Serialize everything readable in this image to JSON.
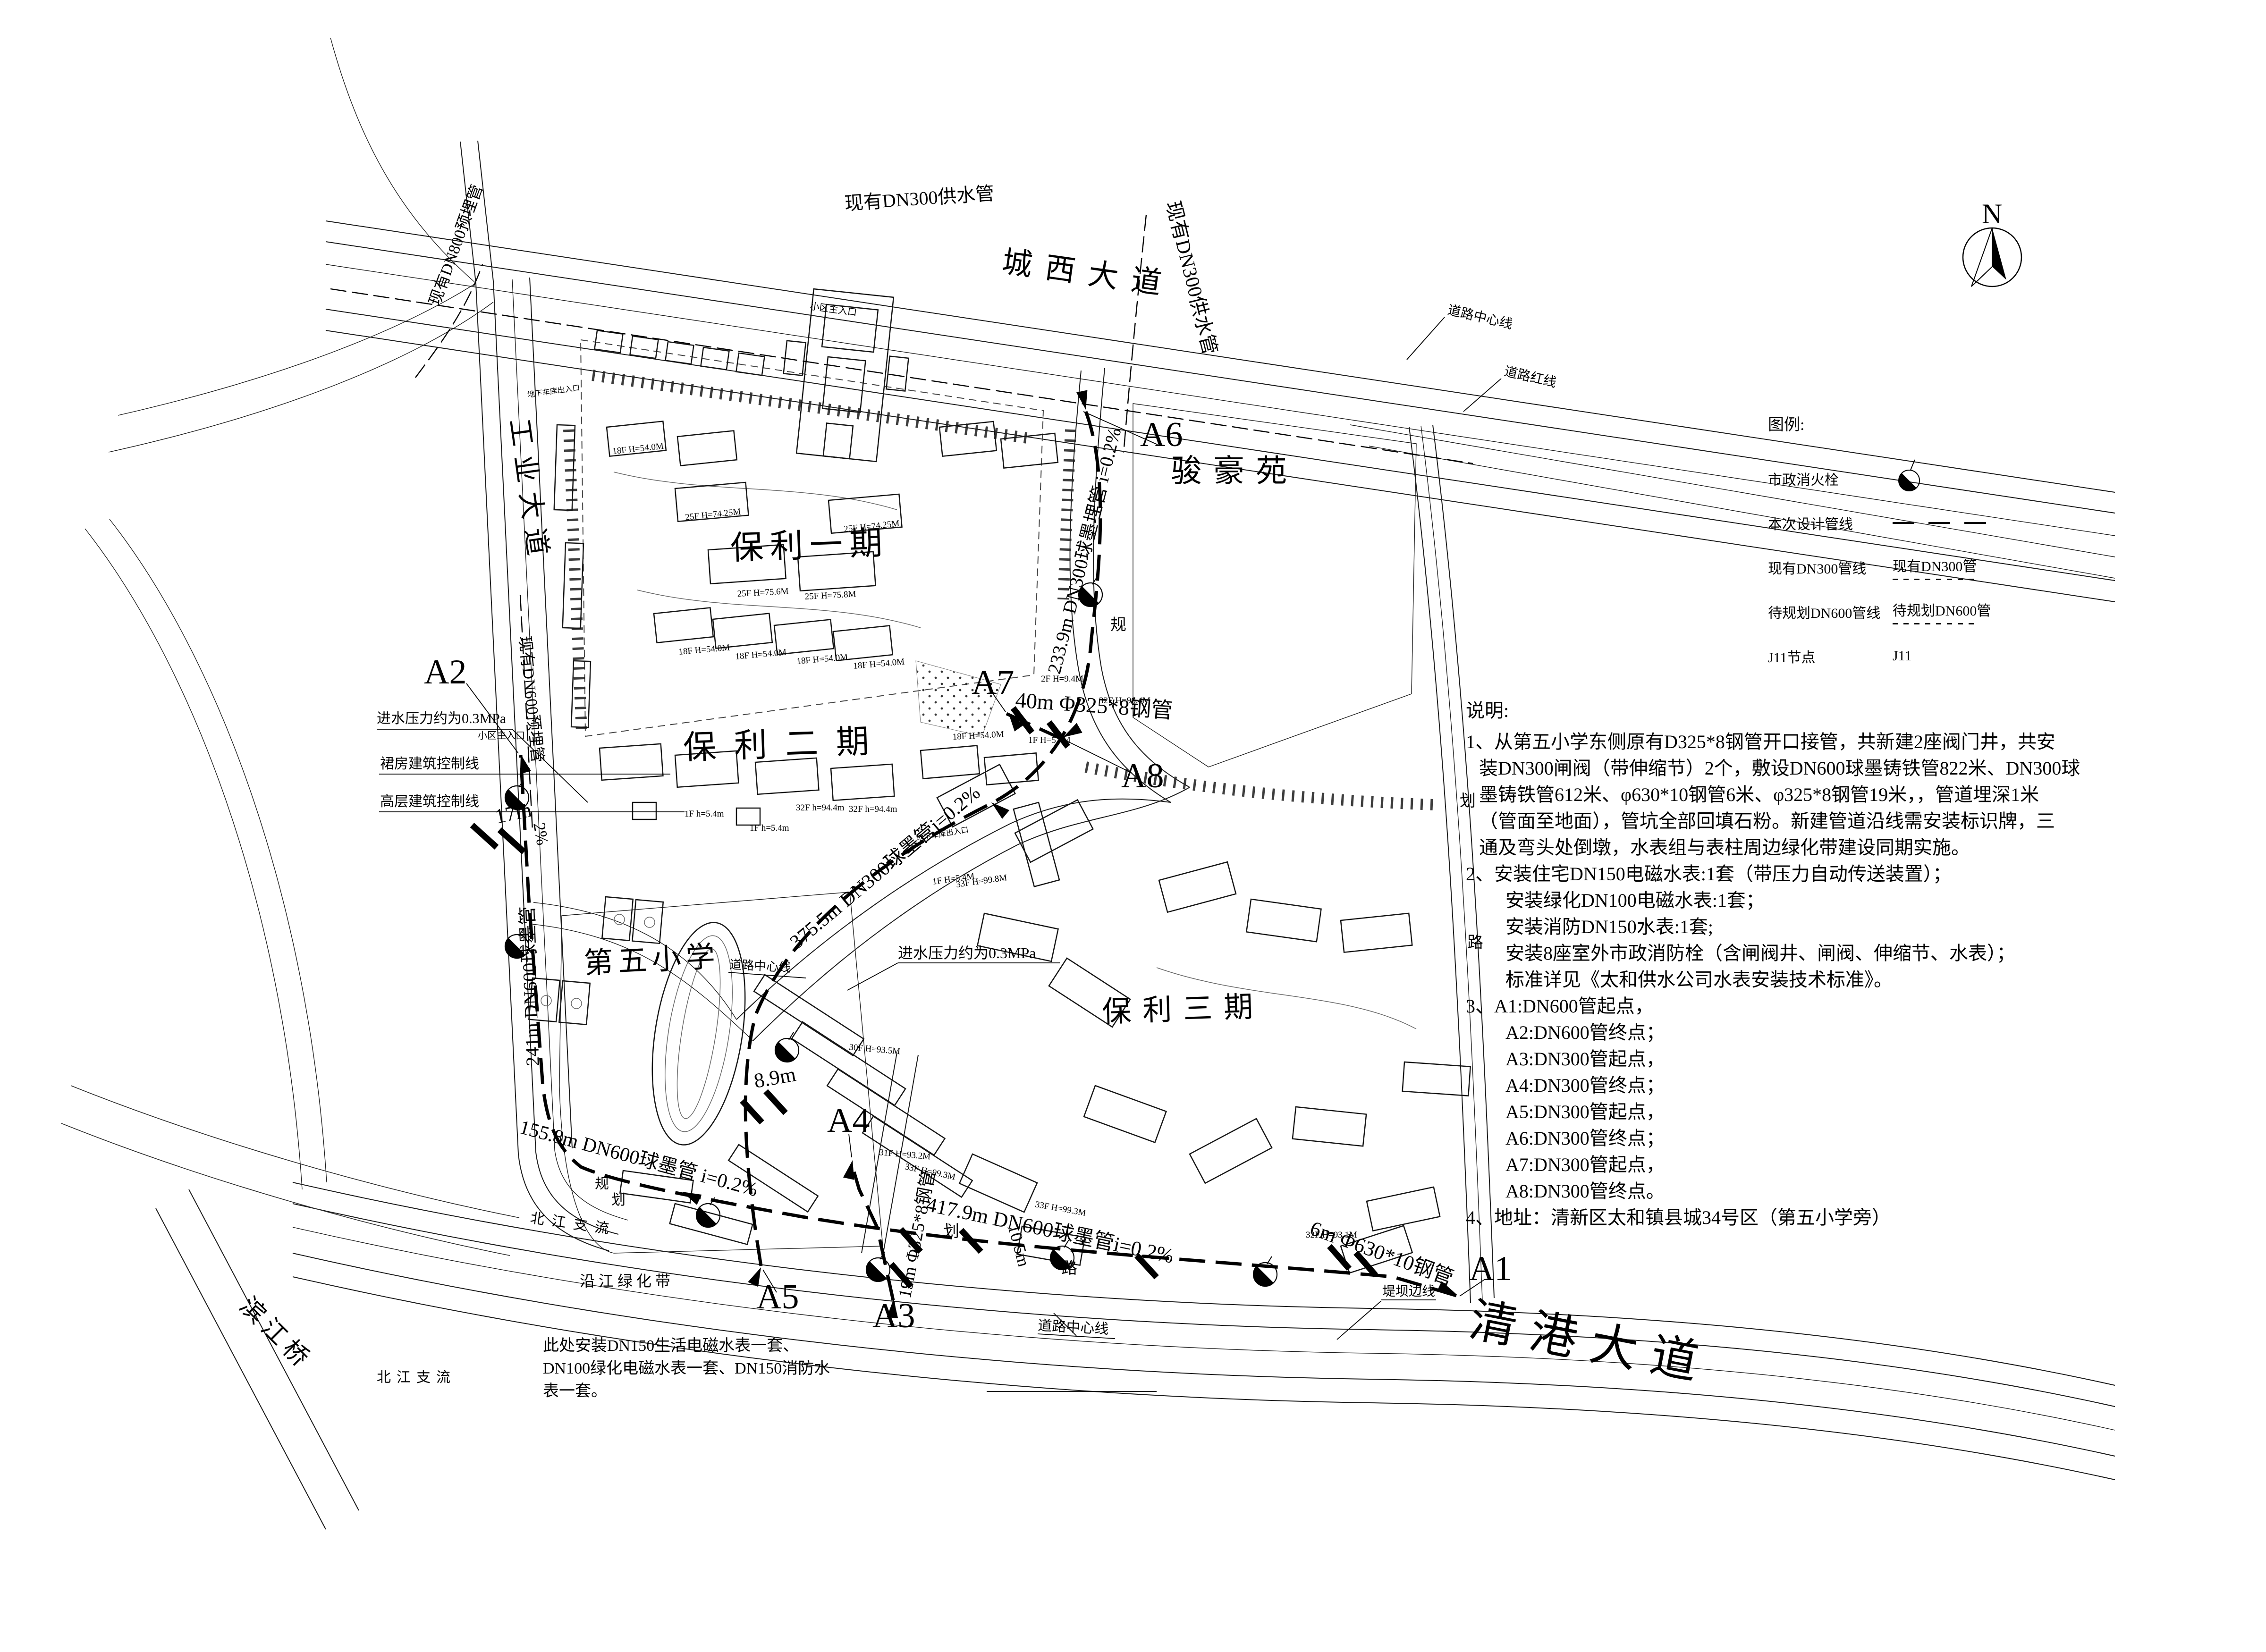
{
  "roads": {
    "chengxi": "城西大道",
    "gongye": "工业大道",
    "qinggang": "清港大道",
    "binjiangqiao": "滨江桥",
    "center_line_tr": "道路中心线",
    "red_line_tr": "道路红线",
    "center_line_school": "道路中心线",
    "center_line_bottom": "道路中心线",
    "dike_edge": "堤坝边线"
  },
  "areas": {
    "junhao": "骏豪苑",
    "baoli1": "保利一期",
    "baoli2": "保利二期",
    "baoli3": "保利三期",
    "school": "第五小学",
    "green_belt": "沿江绿化带",
    "river1": "北江支流",
    "river2": "北江支流"
  },
  "pipes": {
    "existing_dn300_top": "现有DN300供水管",
    "existing_dn300_side": "现有DN300供水管",
    "existing_dn800": "现有DN800预埋管",
    "existing_dn600": "现有DN600预埋管",
    "p233": "233.9m DN300球墨埋管 i=0.2%",
    "p375": "375.5m DN300球墨管i=0.2%",
    "p241": "241m DN600球墨管",
    "p155": "155.8m DN600球墨管 i=0.2%",
    "p417": "417.9m DN600球墨管i=0.2%",
    "p19": "19m Φ325*8钢管",
    "p40": "40m Φ325*8钢管",
    "p6": "6m Φ630*10钢管",
    "p105": "10.5m",
    "p89": "8.9m",
    "p17": "17m",
    "pct2": "2%"
  },
  "nodes": {
    "a1": "A1",
    "a2": "A2",
    "a3": "A3",
    "a4": "A4",
    "a5": "A5",
    "a6": "A6",
    "a7": "A7",
    "a8": "A8"
  },
  "callouts": {
    "pressure1": "进水压力约为0.3MPa",
    "pressure2": "进水压力约为0.3MPa",
    "podium_line": "裙房建筑控制线",
    "tower_line": "高层建筑控制线",
    "entry1": "小区主入口",
    "entry2": "小区主入口",
    "garage1": "地下车库出入口",
    "garage2": "地下车库出入口",
    "meter_note": [
      "此处安装DN150生活电磁水表一套、",
      "DN100绿化电磁水表一套、DN150消防水",
      "表一套。"
    ]
  },
  "plan_chars": {
    "c1": "规",
    "c2": "划",
    "c3": "路",
    "c4": "规",
    "c5": "划",
    "c6": "划",
    "c7": "路"
  },
  "buildings": {
    "b1": "25F H=74.25M",
    "b2": "25F H=74.25M",
    "b3": "25F H=75.6M",
    "b4": "25F H=75.8M",
    "b5": "18F H=54.0M",
    "b6": "18F H=54.0M",
    "b7": "18F H=54.0M",
    "b8": "18F H=54.0M",
    "b9": "18F H=54.0M",
    "b10": "18F H=54.0M",
    "b11": "32F H=96.4M",
    "b12": "2F H=9.4M",
    "b13": "1F H=5.4M",
    "b14": "32F h=94.4m",
    "b15": "32F h=94.4m",
    "b16": "1F h=5.4m",
    "b17": "1F h=5.4m",
    "b18": "33F H=99.3M",
    "b19": "33F H=99.3M",
    "b20": "30F H=93.5M",
    "b21": "31F H=93.2M",
    "b22": "33F H=99.8M",
    "b23": "32F H=93.1M",
    "b24": "1F H=5.4M"
  },
  "legend": {
    "title": "图例:",
    "hydrant_label": "市政消火栓",
    "design_label": "本次设计管线",
    "dn300_label": "现有DN300管线",
    "dn300_value": "现有DN300管",
    "dn600_label": "待规划DN600管线",
    "dn600_value": "待规划DN600管",
    "node_label": "J11节点",
    "node_value": "J11"
  },
  "notes": {
    "title": "说明:",
    "lines": [
      "1、从第五小学东侧原有D325*8钢管开口接管，共新建2座阀门井，共安",
      "装DN300闸阀（带伸缩节）2个，敷设DN600球墨铸铁管822米、DN300球",
      "墨铸铁管612米、φ630*10钢管6米、φ325*8钢管19米，，管道埋深1米",
      "（管面至地面），管坑全部回填石粉。新建管道沿线需安装标识牌，三",
      "通及弯头处倒墩，水表组与表柱周边绿化带建设同期实施。",
      "2、安装住宅DN150电磁水表:1套（带压力自动传送装置）；",
      "安装绿化DN100电磁水表:1套；",
      "安装消防DN150水表:1套;",
      "安装8座室外市政消防栓（含闸阀井、闸阀、伸缩节、水表）；",
      "标准详见《太和供水公司水表安装技术标准》。",
      "3、A1:DN600管起点，",
      "A2:DN600管终点；",
      "A3:DN300管起点，",
      "A4:DN300管终点；",
      "A5:DN300管起点，",
      "A6:DN300管终点；",
      "A7:DN300管起点，",
      "A8:DN300管终点。",
      "4、地址：清新区太和镇县城34号区（第五小学旁）"
    ]
  },
  "north": {
    "label": "N"
  }
}
